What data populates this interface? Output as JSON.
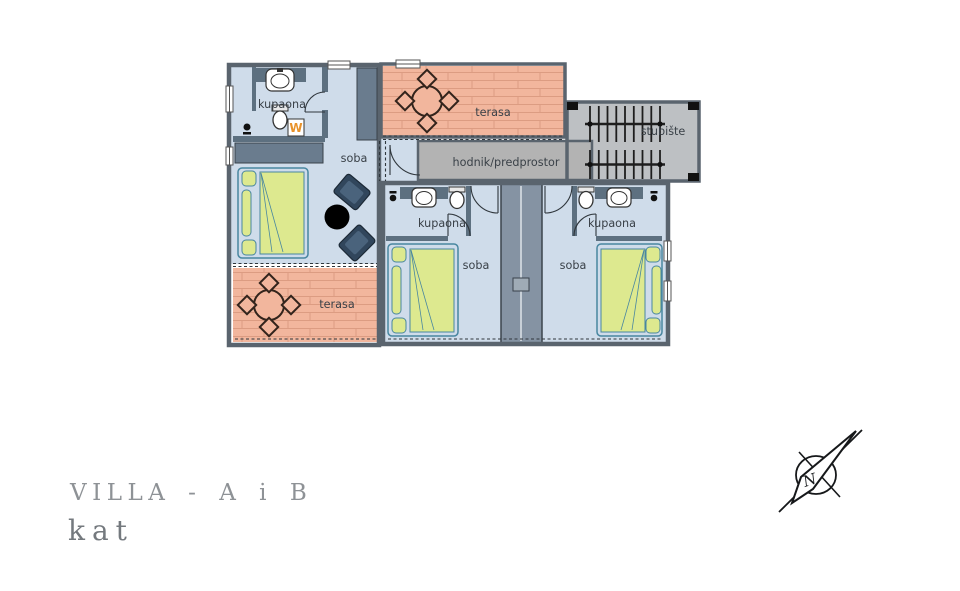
{
  "plan": {
    "labels": {
      "kupaona_a": "kupaona",
      "soba_a": "soba",
      "terasa_top": "terasa",
      "terasa_bottom": "terasa",
      "hodnik": "hodnik/predprostor",
      "stubiste": "stubište",
      "kupaona_b": "kupaona",
      "soba_b": "soba",
      "kupaona_c": "kupaona",
      "soba_c": "soba",
      "washer_symbol": "W"
    }
  },
  "title": {
    "project": "VILLA - A i B",
    "floor": "kat"
  },
  "compass": {
    "north_label": "N"
  },
  "colors": {
    "room_fill": "#cfdcea",
    "terrace_fill": "#f2b69d",
    "terrace_joint": "#dc9c82",
    "hall_fill": "#b3b3b3",
    "stair_fill": "#bdc0c3",
    "wall_dark": "#5d7080",
    "wall_outline": "#4a545e",
    "shaft_fill": "#8593a3",
    "bed_fill": "#dde98f",
    "bed_stroke": "#4886a0",
    "chair_fill": "#31465c",
    "accent_orange": "#e8922a",
    "furniture_line": "#33241c",
    "label_text": "#3a4148",
    "title_text": "#8e9296"
  }
}
